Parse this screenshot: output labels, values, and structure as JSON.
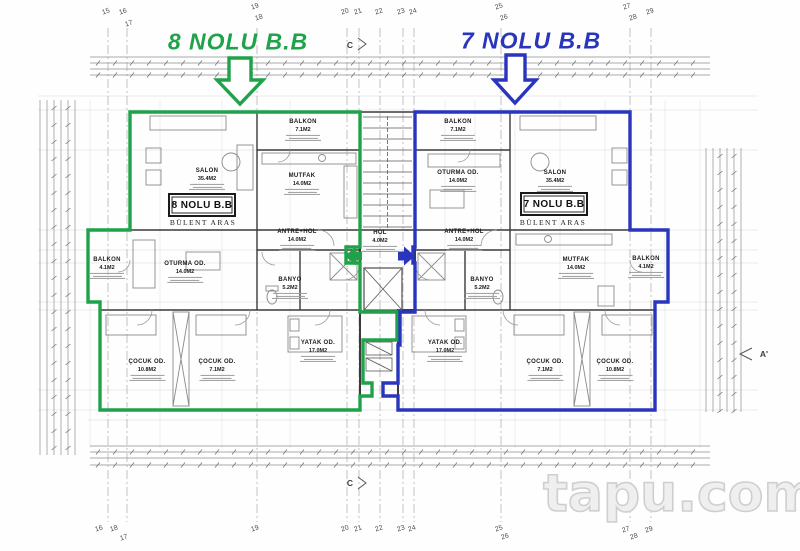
{
  "titles": {
    "left": "8 NOLU B.B",
    "right": "7 NOLU B.B"
  },
  "colors": {
    "unit8": "#1fa24a",
    "unit7": "#2a35bd",
    "walls": "#3a3a3a",
    "watermark": "#cfcfcf"
  },
  "units": [
    {
      "id": "8",
      "box_label": "8 NOLU B.B",
      "owner": "BÜLENT ARAS"
    },
    {
      "id": "7",
      "box_label": "7 NOLU B.B",
      "owner": "BÜLENT ARAS"
    }
  ],
  "rooms": [
    {
      "unit": "8",
      "name": "SALON",
      "area": "35.4M2",
      "x": 207,
      "y": 179
    },
    {
      "unit": "8",
      "name": "BALKON",
      "area": "7.1M2",
      "x": 303,
      "y": 130
    },
    {
      "unit": "8",
      "name": "MUTFAK",
      "area": "14.0M2",
      "x": 302,
      "y": 184
    },
    {
      "unit": "8",
      "name": "ANTRE+HOL",
      "area": "14.0M2",
      "x": 297,
      "y": 240
    },
    {
      "unit": "8",
      "name": "OTURMA OD.",
      "area": "14.0M2",
      "x": 185,
      "y": 272
    },
    {
      "unit": "8",
      "name": "BALKON",
      "area": "4.1M2",
      "x": 107,
      "y": 268
    },
    {
      "unit": "8",
      "name": "BANYO",
      "area": "5.2M2",
      "x": 290,
      "y": 288
    },
    {
      "unit": "8",
      "name": "YATAK OD.",
      "area": "17.0M2",
      "x": 318,
      "y": 351
    },
    {
      "unit": "8",
      "name": "ÇOCUK OD.",
      "area": "10.8M2",
      "x": 147,
      "y": 370
    },
    {
      "unit": "8",
      "name": "ÇOCUK OD.",
      "area": "7.1M2",
      "x": 217,
      "y": 370
    },
    {
      "unit": "common",
      "name": "HOL",
      "area": "4.0M2",
      "x": 380,
      "y": 241
    },
    {
      "unit": "7",
      "name": "BALKON",
      "area": "7.1M2",
      "x": 458,
      "y": 130
    },
    {
      "unit": "7",
      "name": "OTURMA OD.",
      "area": "14.0M2",
      "x": 458,
      "y": 181
    },
    {
      "unit": "7",
      "name": "SALON",
      "area": "35.4M2",
      "x": 555,
      "y": 181
    },
    {
      "unit": "7",
      "name": "ANTRE+HOL",
      "area": "14.0M2",
      "x": 464,
      "y": 240
    },
    {
      "unit": "7",
      "name": "MUTFAK",
      "area": "14.0M2",
      "x": 576,
      "y": 268
    },
    {
      "unit": "7",
      "name": "BALKON",
      "area": "4.1M2",
      "x": 646,
      "y": 267
    },
    {
      "unit": "7",
      "name": "BANYO",
      "area": "5.2M2",
      "x": 482,
      "y": 288
    },
    {
      "unit": "7",
      "name": "YATAK OD.",
      "area": "17.0M2",
      "x": 445,
      "y": 351
    },
    {
      "unit": "7",
      "name": "ÇOCUK OD.",
      "area": "7.1M2",
      "x": 545,
      "y": 370
    },
    {
      "unit": "7",
      "name": "ÇOCUK OD.",
      "area": "10.8M2",
      "x": 615,
      "y": 370
    }
  ],
  "grid": {
    "columns": [
      108,
      127,
      257,
      347,
      359,
      380,
      403,
      414,
      501,
      630,
      651
    ],
    "top": [
      {
        "n": "15",
        "x": 106,
        "y": 12
      },
      {
        "n": "16",
        "x": 123,
        "y": 12
      },
      {
        "n": "17",
        "x": 129,
        "y": 24
      },
      {
        "n": "19",
        "x": 255,
        "y": 7
      },
      {
        "n": "18",
        "x": 259,
        "y": 18
      },
      {
        "n": "20",
        "x": 345,
        "y": 12
      },
      {
        "n": "21",
        "x": 358,
        "y": 12
      },
      {
        "n": "22",
        "x": 379,
        "y": 12
      },
      {
        "n": "23",
        "x": 401,
        "y": 12
      },
      {
        "n": "24",
        "x": 413,
        "y": 12
      },
      {
        "n": "25",
        "x": 499,
        "y": 7
      },
      {
        "n": "26",
        "x": 504,
        "y": 18
      },
      {
        "n": "27",
        "x": 627,
        "y": 7
      },
      {
        "n": "28",
        "x": 633,
        "y": 18
      },
      {
        "n": "29",
        "x": 650,
        "y": 12
      }
    ],
    "bottom": [
      {
        "n": "16",
        "x": 99,
        "y": 529
      },
      {
        "n": "18",
        "x": 114,
        "y": 529
      },
      {
        "n": "17",
        "x": 124,
        "y": 538
      },
      {
        "n": "19",
        "x": 255,
        "y": 529
      },
      {
        "n": "20",
        "x": 345,
        "y": 529
      },
      {
        "n": "21",
        "x": 358,
        "y": 529
      },
      {
        "n": "22",
        "x": 379,
        "y": 529
      },
      {
        "n": "23",
        "x": 401,
        "y": 529
      },
      {
        "n": "24",
        "x": 412,
        "y": 529
      },
      {
        "n": "25",
        "x": 499,
        "y": 529
      },
      {
        "n": "26",
        "x": 505,
        "y": 537
      },
      {
        "n": "27",
        "x": 626,
        "y": 530
      },
      {
        "n": "28",
        "x": 634,
        "y": 537
      },
      {
        "n": "29",
        "x": 649,
        "y": 530
      }
    ]
  },
  "section_markers": [
    {
      "label": "C",
      "x": 350,
      "y": 45
    },
    {
      "label": "C",
      "x": 350,
      "y": 483
    },
    {
      "label": "A'",
      "x": 764,
      "y": 354
    }
  ],
  "watermark": "tapu.com"
}
